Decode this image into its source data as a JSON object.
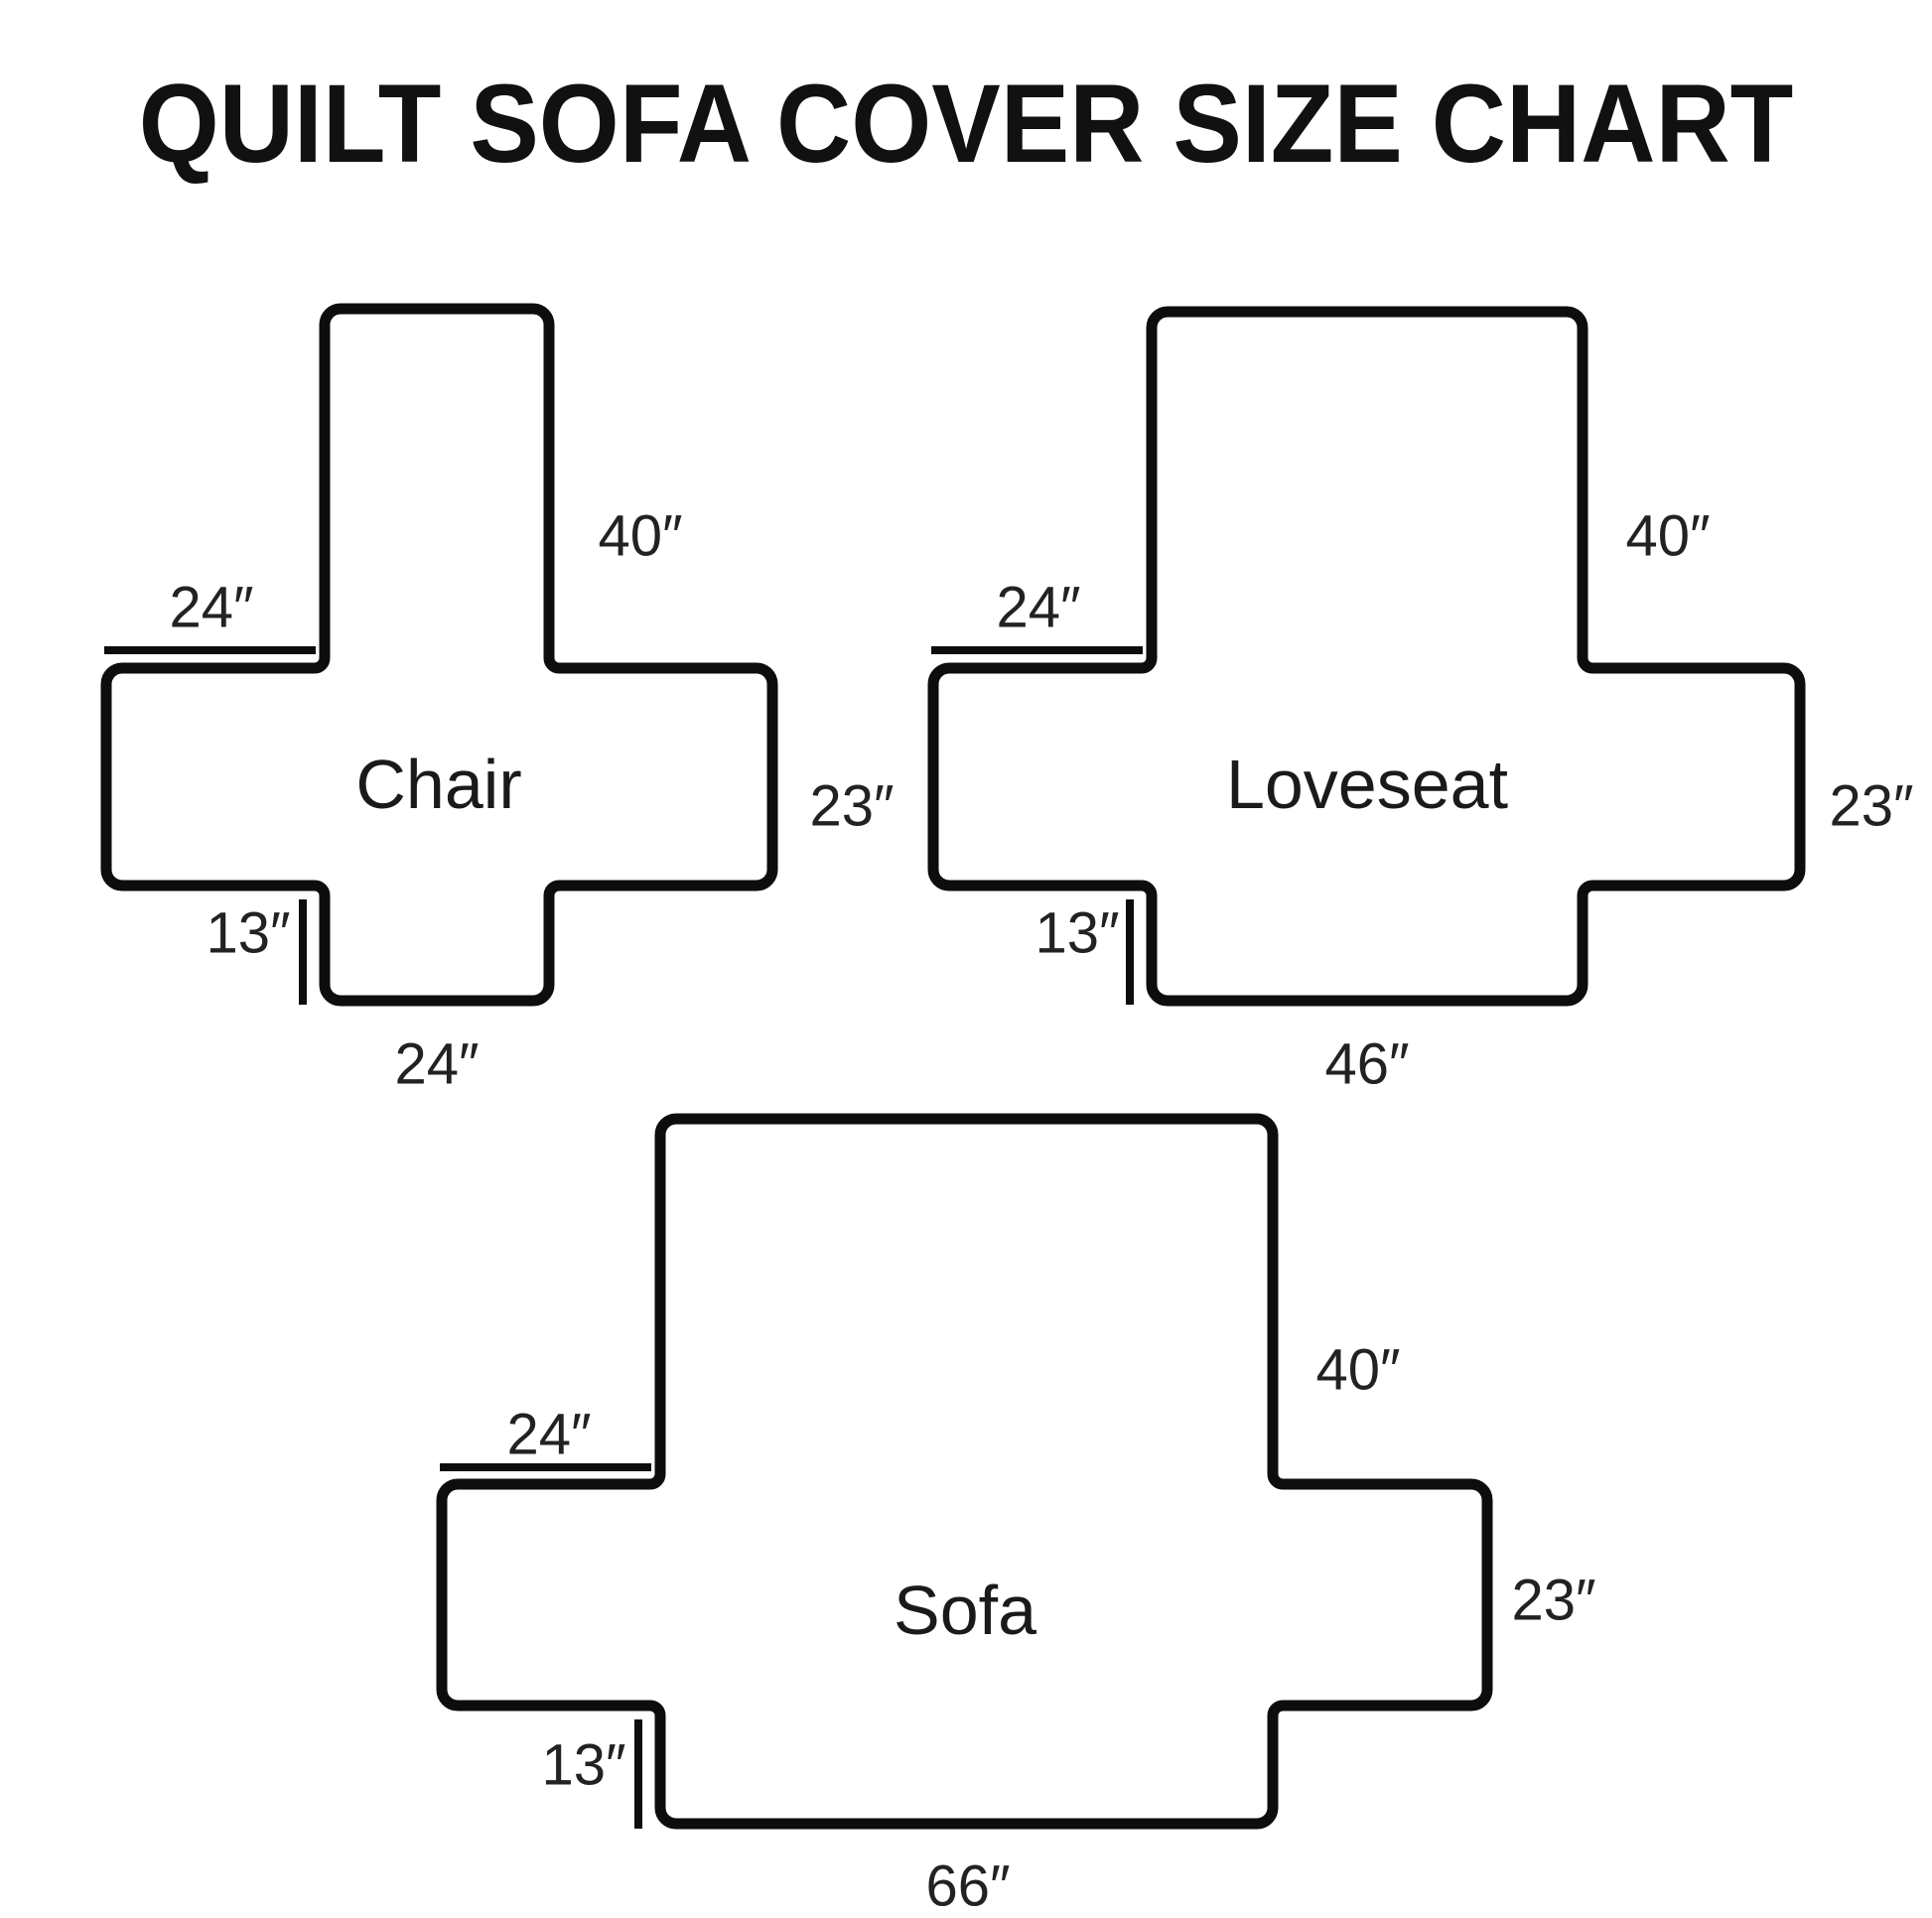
{
  "title": "QUILT SOFA COVER SIZE CHART",
  "unit": "inches",
  "diagrams": [
    {
      "name": "Chair",
      "back_height": "40″",
      "arm_width": "24″",
      "side_depth": "23″",
      "skirt_drop": "13″",
      "bottom_width": "24″"
    },
    {
      "name": "Loveseat",
      "back_height": "40″",
      "arm_width": "24″",
      "side_depth": "23″",
      "skirt_drop": "13″",
      "bottom_width": "46″"
    },
    {
      "name": "Sofa",
      "back_height": "40″",
      "arm_width": "24″",
      "side_depth": "23″",
      "skirt_drop": "13″",
      "bottom_width": "66″"
    }
  ],
  "measurements_inches": {
    "back_height": 40,
    "arm_width": 24,
    "side_depth": 23,
    "skirt_drop": 13,
    "bottom_width": {
      "chair": 24,
      "loveseat": 46,
      "sofa": 66
    }
  },
  "colors": {
    "background": "#ffffff",
    "line": "#0d0d0d",
    "text": "#222222"
  }
}
